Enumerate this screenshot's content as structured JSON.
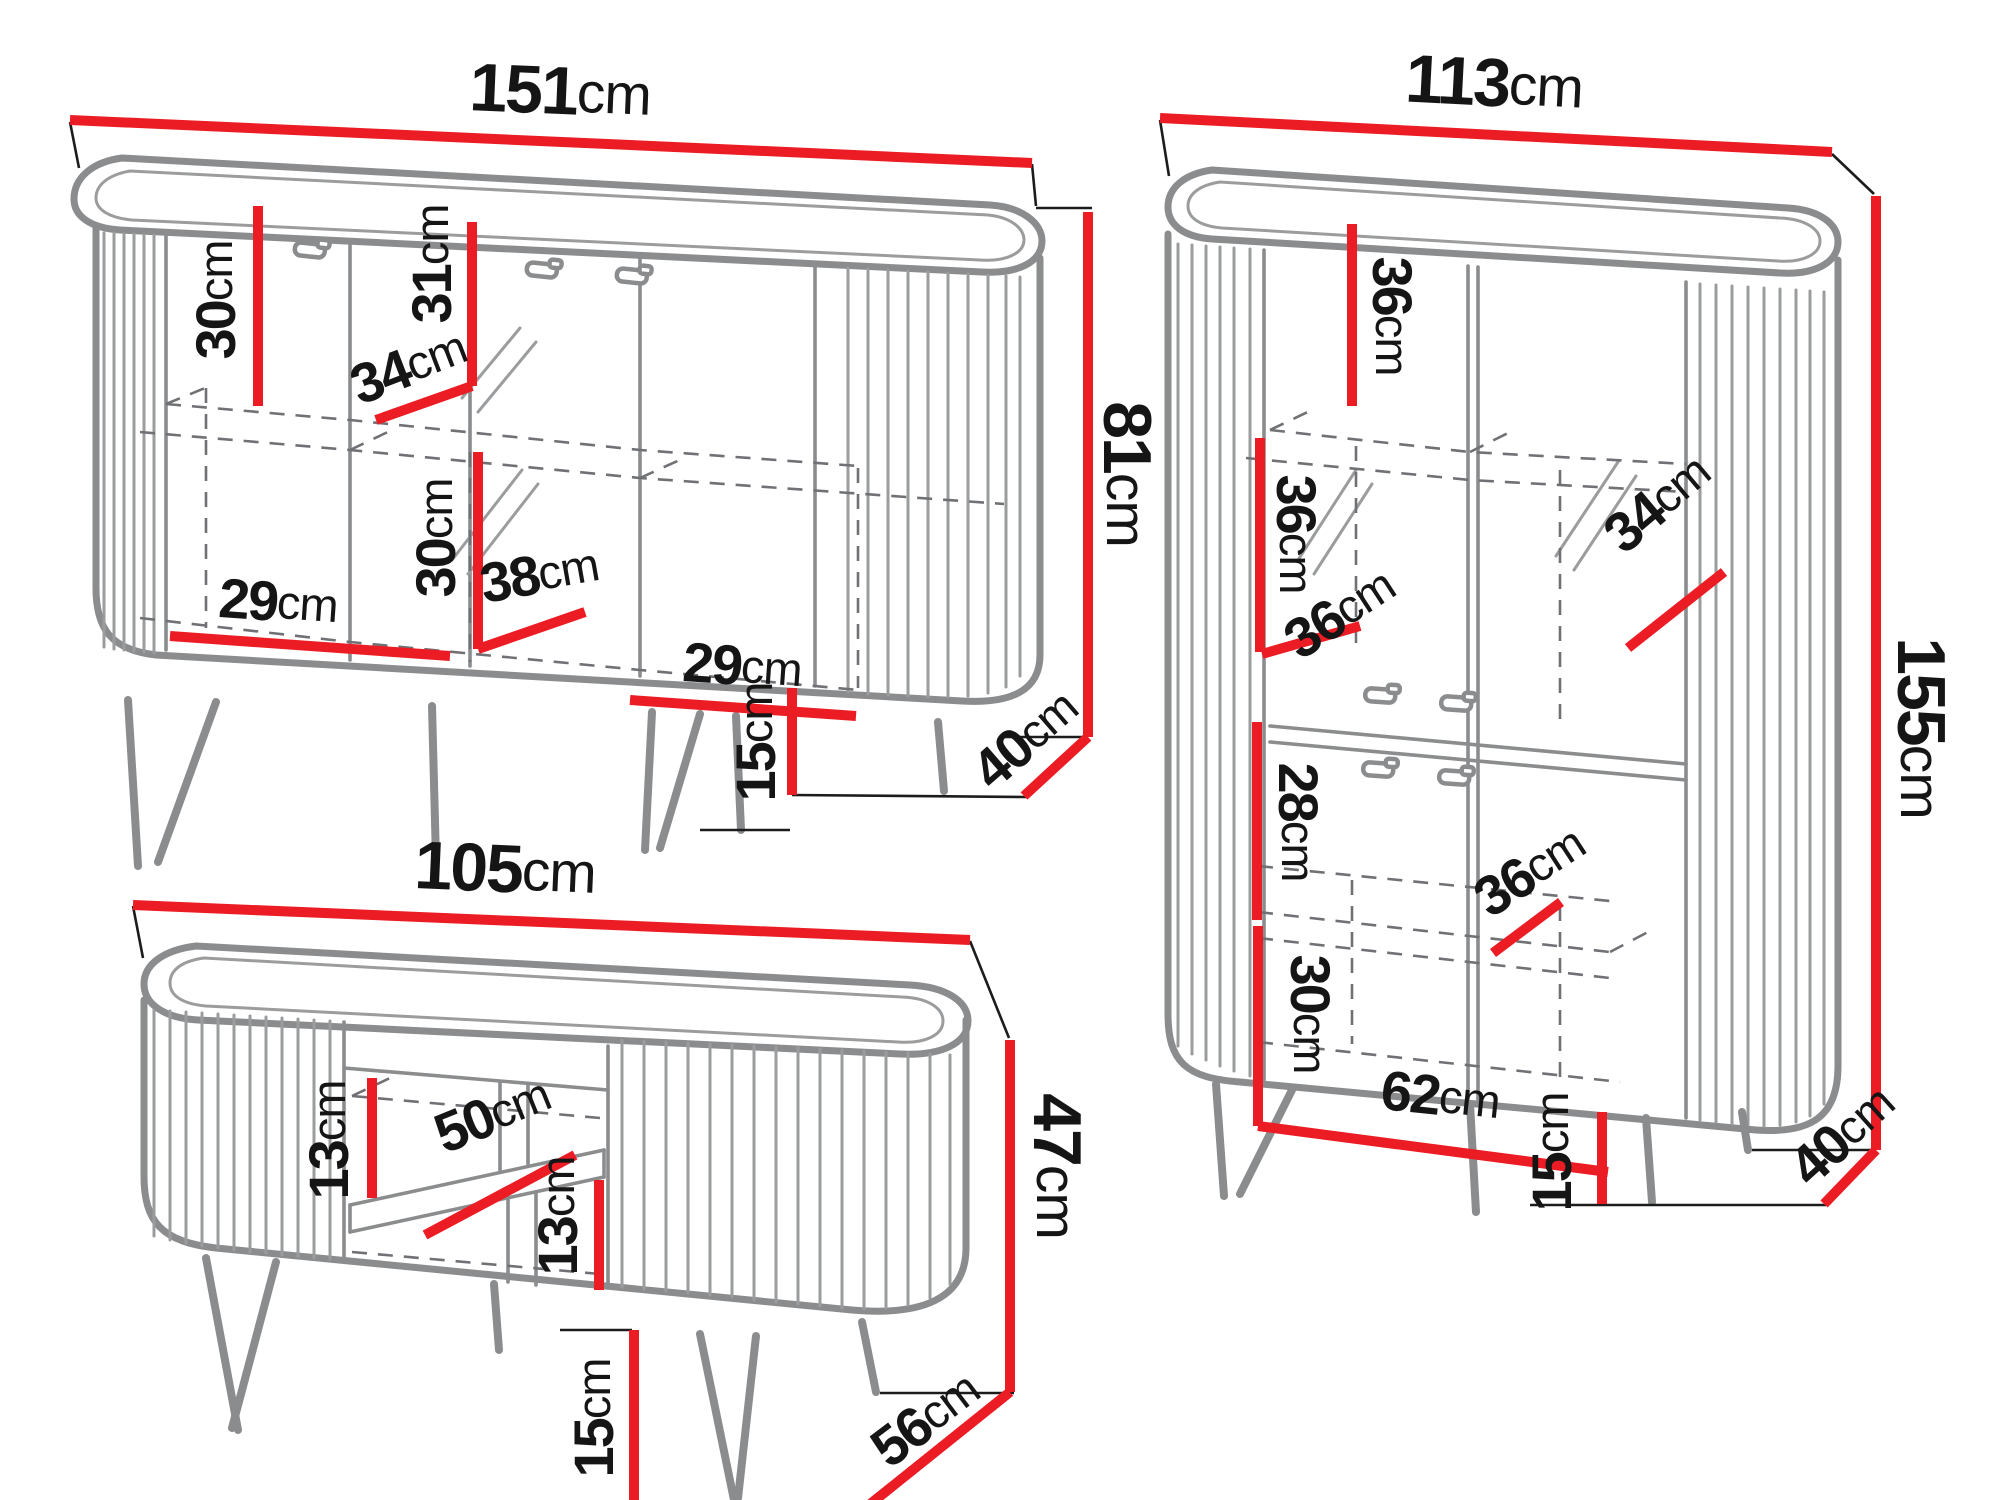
{
  "unit": "cm",
  "colors": {
    "dimension_red": "#ec1c24",
    "drawing_gray": "#8a8c8e",
    "label_black": "#151515",
    "background": "#ffffff"
  },
  "furniture": [
    {
      "name": "sideboard",
      "overall": {
        "width": "151",
        "height": "81",
        "depth": "40",
        "leg_height": "15"
      },
      "internal": {
        "upper_section_height": "30",
        "shelf_depth": "34",
        "door_inner_height": "31",
        "lower_section_height": "30",
        "lower_section_width": "38",
        "bottom_left_width": "29",
        "bottom_right_width": "29"
      }
    },
    {
      "name": "display-cabinet",
      "overall": {
        "width": "113",
        "height": "155",
        "depth": "40",
        "leg_height": "15"
      },
      "internal": {
        "top_section_height": "36",
        "top_shelf_depth": "34",
        "middle_section_height": "36",
        "middle_shelf_width": "36",
        "lower_section_height": "28",
        "lower_shelf_depth": "36",
        "bottom_section_height": "30",
        "bottom_inner_width": "62"
      }
    },
    {
      "name": "tv-stand",
      "overall": {
        "width": "105",
        "height": "47",
        "depth": "56",
        "leg_height": "15"
      },
      "internal": {
        "niche_upper_height": "13",
        "shelf_depth": "50",
        "niche_lower_height": "13"
      }
    }
  ]
}
